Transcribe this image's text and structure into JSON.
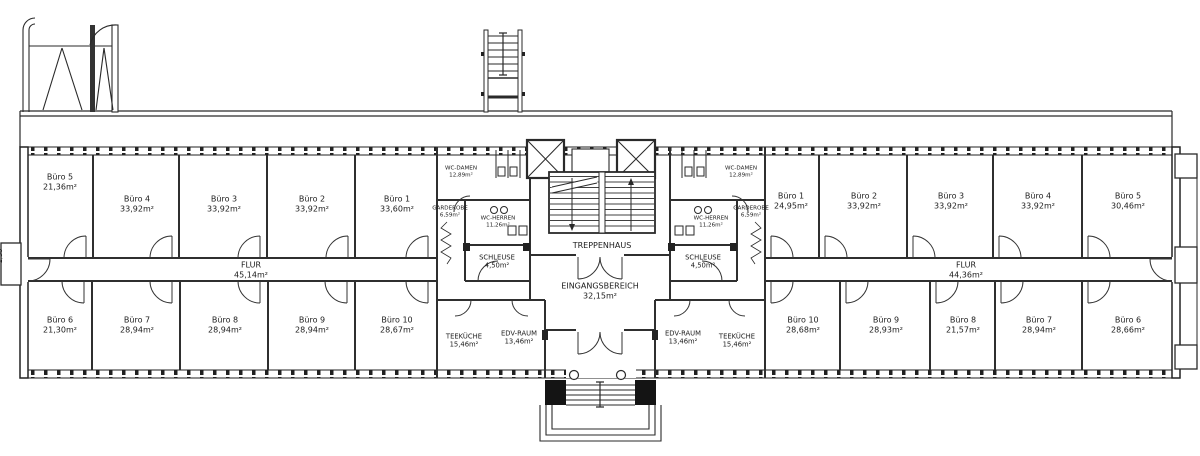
{
  "colors": {
    "ink": "#1c1c1c",
    "background": "#ffffff"
  },
  "left_wing": {
    "top_rooms": [
      {
        "name": "Büro 5",
        "area": "21,36m²"
      },
      {
        "name": "Büro 4",
        "area": "33,92m²"
      },
      {
        "name": "Büro 3",
        "area": "33,92m²"
      },
      {
        "name": "Büro 2",
        "area": "33,92m²"
      },
      {
        "name": "Büro 1",
        "area": "33,60m²"
      }
    ],
    "corridor": {
      "name": "FLUR",
      "area": "45,14m²"
    },
    "bottom_rooms": [
      {
        "name": "Büro 6",
        "area": "21,30m²"
      },
      {
        "name": "Büro 7",
        "area": "28,94m²"
      },
      {
        "name": "Büro 8",
        "area": "28,94m²"
      },
      {
        "name": "Büro 9",
        "area": "28,94m²"
      },
      {
        "name": "Büro 10",
        "area": "28,67m²"
      }
    ]
  },
  "center_left": {
    "wc_damen": {
      "name": "WC-DAMEN",
      "area": "12,89m²"
    },
    "garderobe": {
      "name": "GARDEROBE",
      "area": "6,59m²"
    },
    "wc_herren": {
      "name": "WC-HERREN",
      "area": "11,26m²"
    },
    "schleuse": {
      "name": "SCHLEUSE",
      "area": "4,50m²"
    },
    "teekueche": {
      "name": "TEEKÜCHE",
      "area": "15,46m²"
    },
    "edv_raum": {
      "name": "EDV-RAUM",
      "area": "13,46m²"
    }
  },
  "core": {
    "treppenhaus": {
      "name": "TREPPENHAUS"
    },
    "eingangsbereich": {
      "name": "EINGANGSBEREICH",
      "area": "32,15m²"
    }
  },
  "center_right": {
    "wc_damen": {
      "name": "WC-DAMEN",
      "area": "12,89m²"
    },
    "garderobe": {
      "name": "GARDEROBE",
      "area": "6,59m²"
    },
    "wc_herren": {
      "name": "WC-HERREN",
      "area": "11,26m²"
    },
    "schleuse": {
      "name": "SCHLEUSE",
      "area": "4,50m²"
    },
    "edv_raum": {
      "name": "EDV-RAUM",
      "area": "13,46m²"
    },
    "teekueche": {
      "name": "TEEKÜCHE",
      "area": "15,46m²"
    }
  },
  "right_wing": {
    "top_rooms": [
      {
        "name": "Büro 1",
        "area": "24,95m²"
      },
      {
        "name": "Büro 2",
        "area": "33,92m²"
      },
      {
        "name": "Büro 3",
        "area": "33,92m²"
      },
      {
        "name": "Büro 4",
        "area": "33,92m²"
      },
      {
        "name": "Büro 5",
        "area": "30,46m²"
      }
    ],
    "corridor": {
      "name": "FLUR",
      "area": "44,36m²"
    },
    "bottom_rooms": [
      {
        "name": "Büro 10",
        "area": "28,68m²"
      },
      {
        "name": "Büro 9",
        "area": "28,93m²"
      },
      {
        "name": "Büro 8",
        "area": "21,57m²"
      },
      {
        "name": "Büro 7",
        "area": "28,94m²"
      },
      {
        "name": "Büro 6",
        "area": "28,66m²"
      }
    ]
  },
  "annotations": {
    "left_dimension": "1,50"
  }
}
